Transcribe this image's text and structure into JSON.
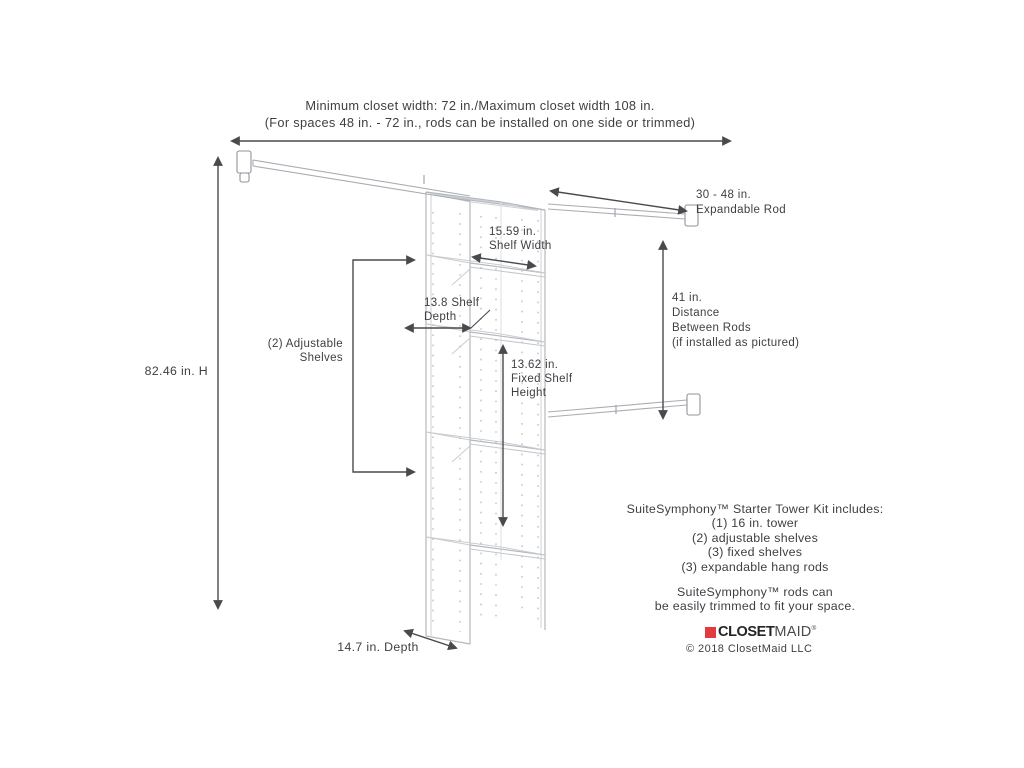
{
  "header": {
    "line1": "Minimum closet width: 72 in./Maximum closet width 108 in.",
    "line2": "(For spaces 48 in. - 72 in., rods can be installed on one side or trimmed)"
  },
  "dimensions": {
    "height_label": "82.46 in. H",
    "expandable_rod": {
      "line1": "30 - 48 in.",
      "line2": "Expandable Rod"
    },
    "shelf_width": {
      "line1": "15.59 in.",
      "line2": "Shelf Width"
    },
    "shelf_depth": {
      "line1": "13.8 Shelf",
      "line2": "Depth"
    },
    "adjustable_shelves": {
      "line1": "(2) Adjustable",
      "line2": "Shelves"
    },
    "fixed_shelf_height": {
      "line1": "13.62 in.",
      "line2": "Fixed Shelf",
      "line3": "Height"
    },
    "rod_distance": {
      "line1": "41 in.",
      "line2": "Distance",
      "line3": "Between Rods",
      "line4": "(if installed as pictured)"
    },
    "depth_label": "14.7 in. Depth"
  },
  "kit_info": {
    "title": "SuiteSymphony™ Starter Tower Kit includes:",
    "items": [
      "(1) 16 in. tower",
      "(2) adjustable shelves",
      "(3) fixed shelves",
      "(3) expandable hang rods"
    ],
    "note_line1": "SuiteSymphony™ rods can",
    "note_line2": "be easily trimmed to fit your space."
  },
  "branding": {
    "logo_closet": "CLOSET",
    "logo_maid": "MAID",
    "logo_reg": "®",
    "copyright": "© 2018 ClosetMaid LLC",
    "logo_red": "#e23b3f"
  }
}
